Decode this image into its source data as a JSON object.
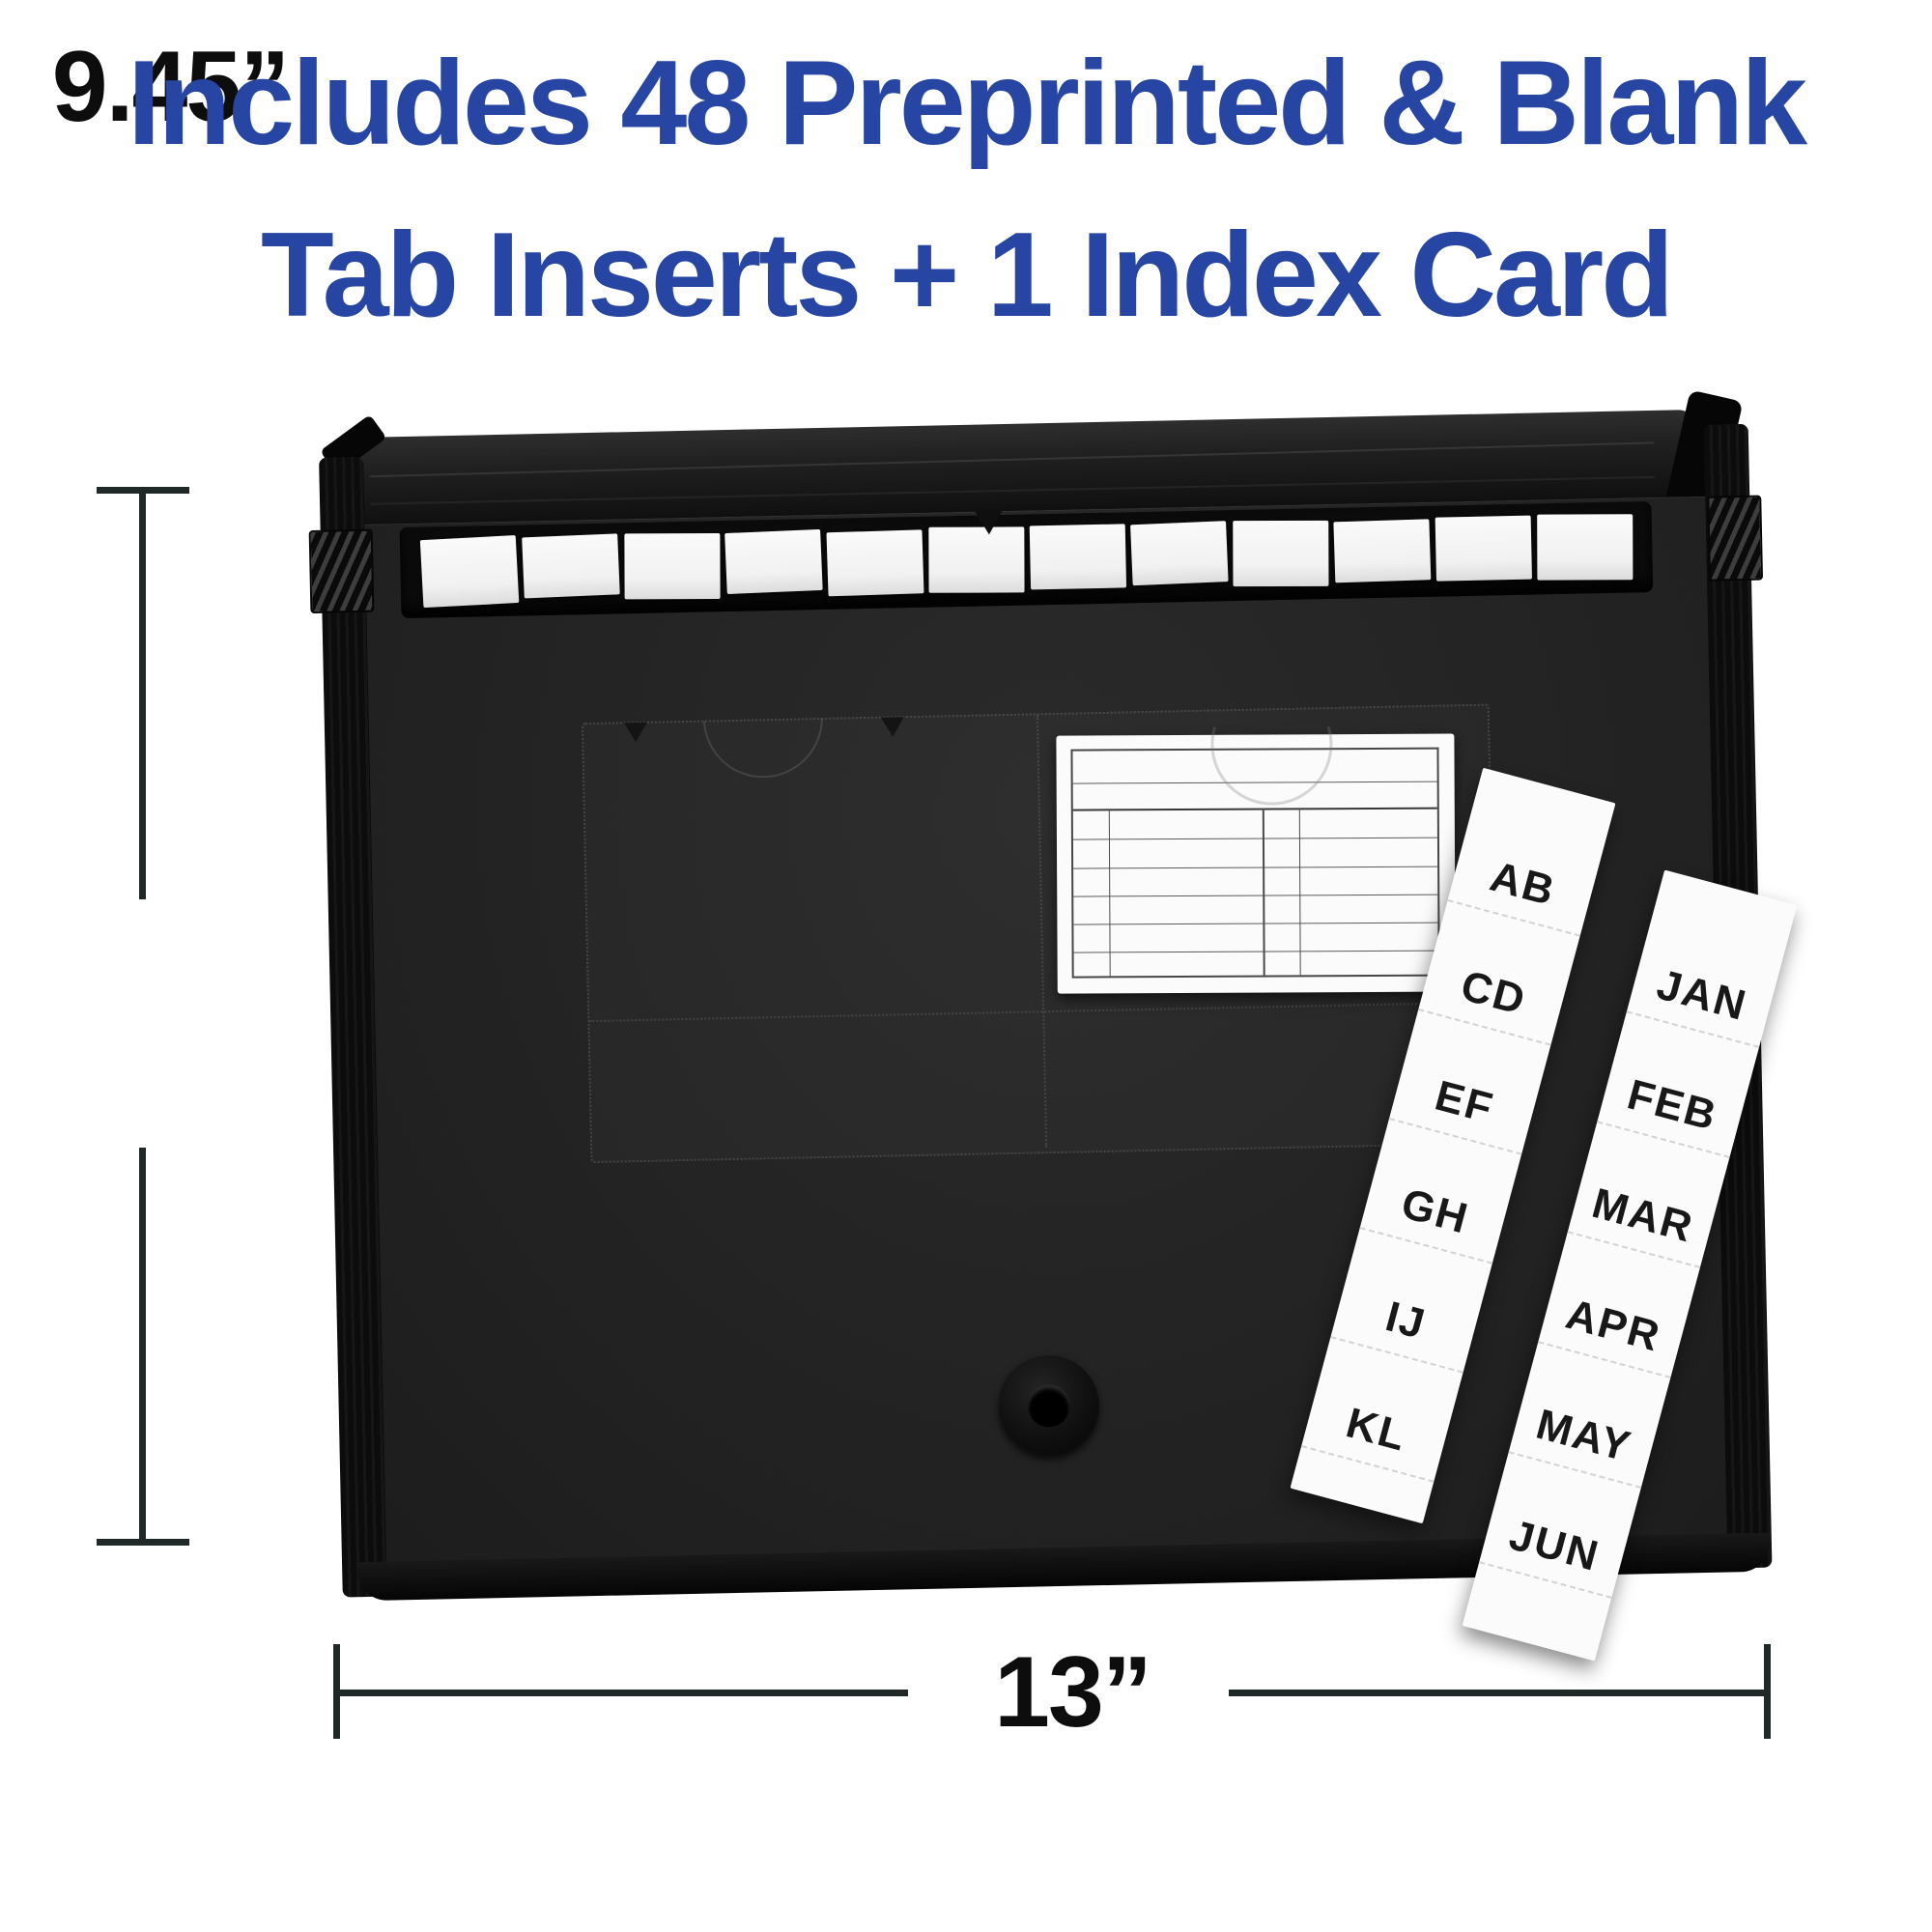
{
  "headline": {
    "line1": "Includes 48 Preprinted & Blank",
    "line2": "Tab Inserts + 1 Index Card",
    "color": "#2746a3"
  },
  "dimensions": {
    "height_label": "9.45”",
    "width_label": "13”",
    "line_color": "#202828",
    "text_color": "#0d0d0d"
  },
  "folder": {
    "body_color": "#232323",
    "lid_color": "#1a1a1a",
    "mouth_color": "#0b0b0b",
    "strap_color": "#0c0c0c",
    "visible_blank_tab_inserts": 12
  },
  "index_card": {
    "background": "#fbfbfb",
    "grid_line_color": "#4a4a4a"
  },
  "tab_strips": {
    "letters": {
      "labels": [
        "AB",
        "CD",
        "EF",
        "GH",
        "IJ",
        "KL"
      ]
    },
    "months": {
      "labels": [
        "JAN",
        "FEB",
        "MAR",
        "APR",
        "MAY",
        "JUN"
      ]
    }
  }
}
